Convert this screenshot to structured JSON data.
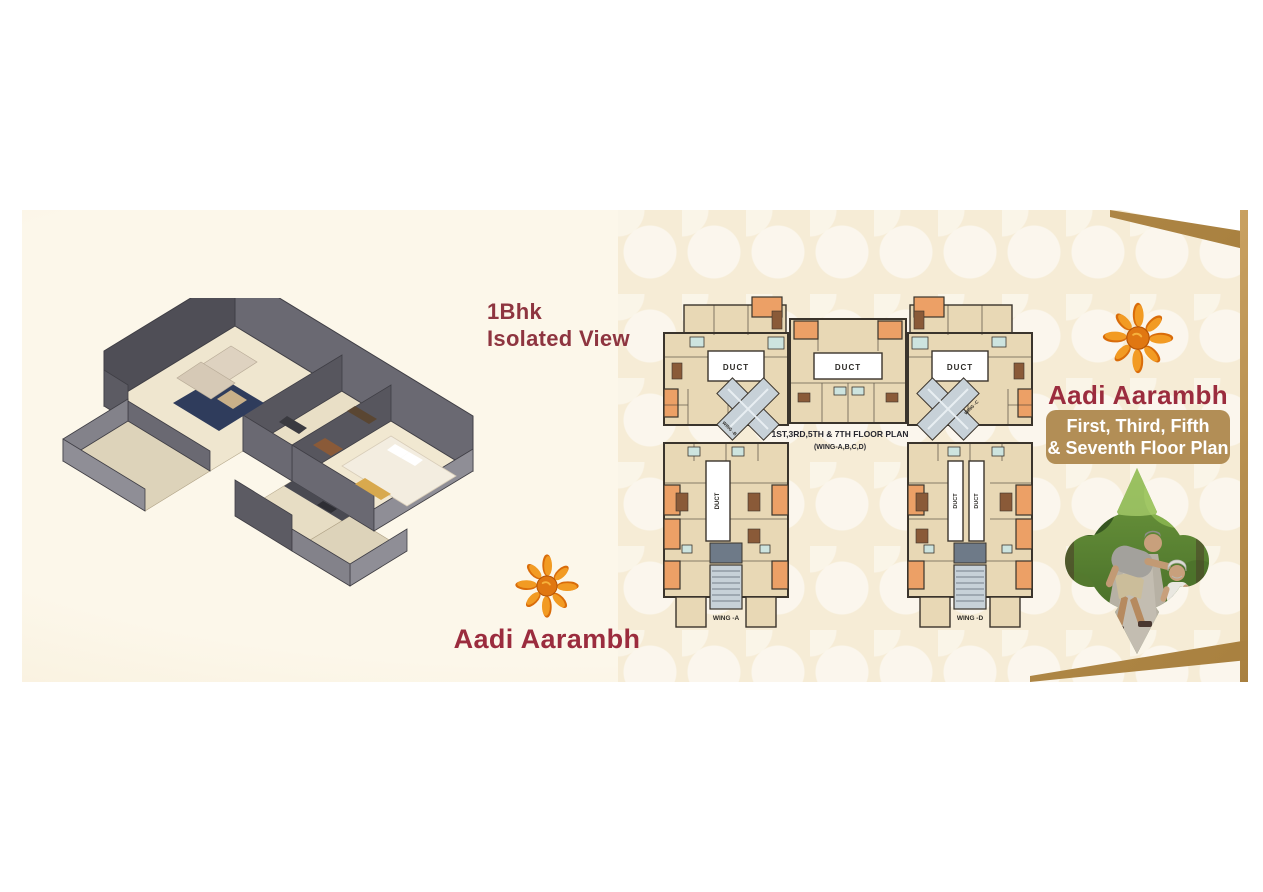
{
  "brand": {
    "name": "Aadi Aarambh",
    "text_color": "#9b2c3e",
    "sun_primary": "#e8790f",
    "sun_secondary": "#f5a623"
  },
  "band": {
    "bg": "#f7eed9",
    "ribbon_color": "#b8914f"
  },
  "left_panel": {
    "heading_line1": "1Bhk",
    "heading_line2": "Isolated View",
    "heading_color": "#8e3540",
    "illustration": "1bhk-isometric-apartment-3d-view"
  },
  "floor_plan": {
    "title_line1": "1ST,3RD,5TH & 7TH FLOOR PLAN",
    "title_line2": "(WING-A,B,C,D)",
    "duct_label": "DUCT",
    "wing_labels": {
      "a": "WING -A",
      "b": "WING -B",
      "c": "WING -C",
      "d": "WING -D"
    },
    "colors": {
      "room": "#e8d8b5",
      "accent_room": "#eca066",
      "bath": "#cde4df",
      "wall": "#3a342c",
      "stair": "#c7d1d8"
    }
  },
  "right_panel": {
    "banner": {
      "line1": "First, Third, Fifth",
      "line2": "& Seventh Floor Plan",
      "bg": "#b28e56",
      "text_color": "#ffffff"
    },
    "photo_label": "father-teaching-child-to-ride-bicycle"
  }
}
